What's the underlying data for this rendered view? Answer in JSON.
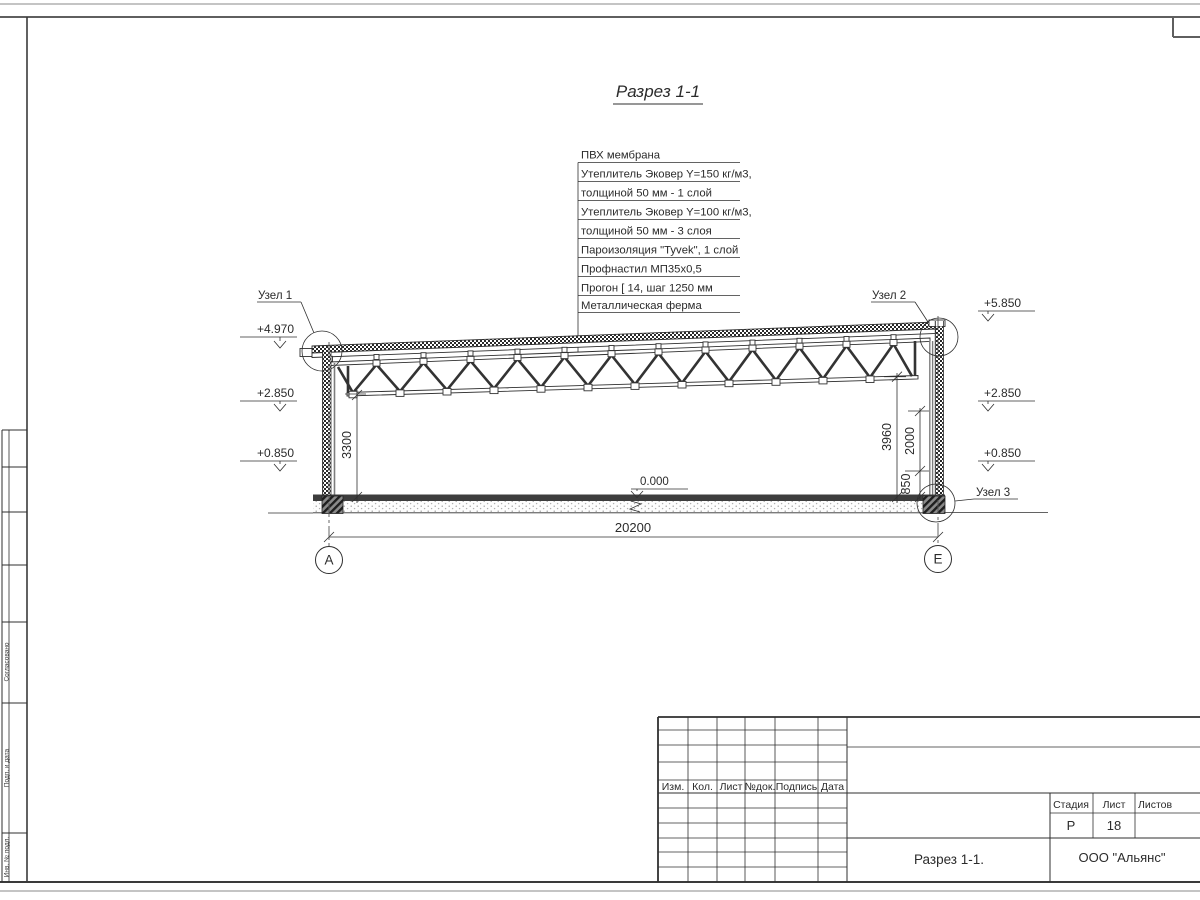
{
  "drawing": {
    "title": "Разрез 1-1",
    "callouts": [
      "ПВХ мембрана",
      "Утеплитель Эковер Y=150 кг/м3,",
      "толщиной 50 мм - 1 слой",
      "Утеплитель Эковер Y=100 кг/м3,",
      "толщиной 50 мм - 3 слоя",
      "Пароизоляция \"Tyvek\", 1 слой",
      "Профнастил МП35х0,5",
      "Прогон [ 14, шаг 1250 мм",
      "Металлическая ферма"
    ],
    "levels": {
      "left_top": "+4.970",
      "left_mid": "+2.850",
      "left_low": "+0.850",
      "right_top": "+5.850",
      "right_mid": "+2.850",
      "right_low": "+0.850",
      "zero": "0.000"
    },
    "nodes": {
      "node1": "Узел 1",
      "node2": "Узел 2",
      "node3": "Узел 3"
    },
    "dimensions": {
      "left_height": "3300",
      "right_height": "3960",
      "right_mid": "2000",
      "right_low": "850",
      "span": "20200"
    },
    "axes": {
      "left": "А",
      "right": "Е"
    }
  },
  "titleblock": {
    "rev_headers": [
      "Изм.",
      "Кол.",
      "Лист",
      "№док.",
      "Подпись",
      "Дата"
    ],
    "stage_label": "Стадия",
    "sheet_label": "Лист",
    "sheets_label": "Листов",
    "stage_value": "Р",
    "sheet_value": "18",
    "sheets_value": "",
    "drawing_name": "Разрез 1-1.",
    "company": "ООО \"Альянс\""
  },
  "margin": {
    "labels": [
      "Согласовано",
      "Подп. и дата",
      "Инв. № подл."
    ]
  }
}
